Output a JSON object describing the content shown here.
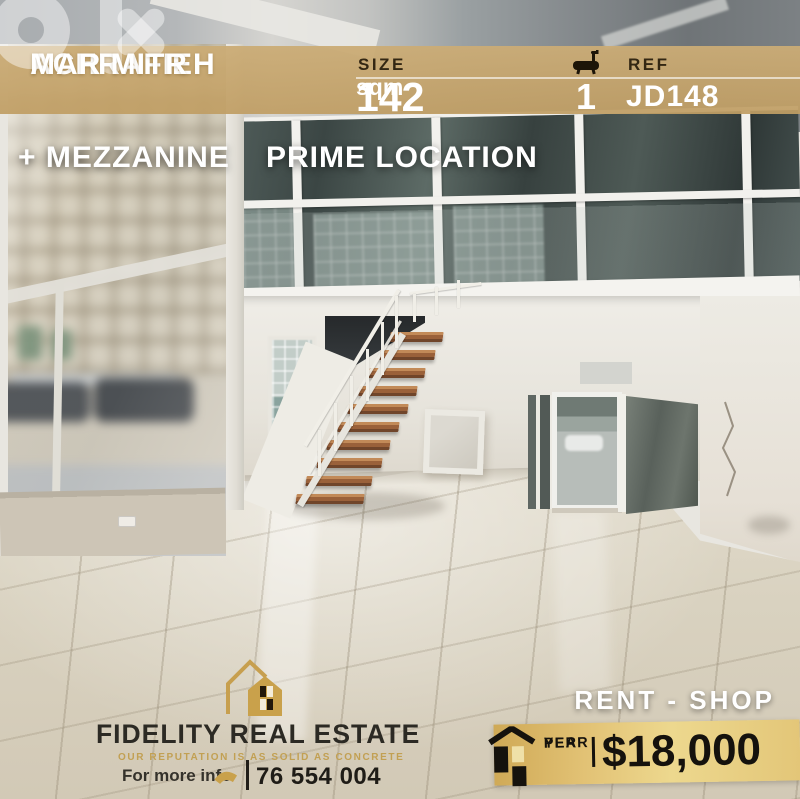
{
  "watermark": {
    "icon": "olx-logo"
  },
  "top_banner": {
    "bg_color": "#c7a66e",
    "location_line1": "ACHRAFIEH",
    "location_line2": "MAR MITR",
    "size": {
      "label": "SIZE",
      "value": "142",
      "unit": "sqm"
    },
    "bathrooms": {
      "icon": "bathtub-icon",
      "value": "1"
    },
    "reference": {
      "label": "REF",
      "value": "JD148"
    }
  },
  "features": {
    "line1": "+ MEZZANINE",
    "line2": "PRIME LOCATION"
  },
  "brand": {
    "logo_icon": "double-house-icon",
    "name": "FIDELITY REAL ESTATE",
    "tagline": "OUR REPUTATION IS AS SOLID AS CONCRETE",
    "contact_label": "For more info",
    "phone_icon": "phone-handset-icon",
    "phone": "76 554 004",
    "gold_color": "#c49b4e",
    "text_color": "#2c2a24"
  },
  "offer": {
    "listing_type": "RENT - SHOP",
    "price_banner": {
      "bg_color": "#e5c878",
      "house_icon": "house-silhouette-icon",
      "period_line1": "PER",
      "period_line2": "YEAR",
      "price": "$18,000"
    }
  }
}
